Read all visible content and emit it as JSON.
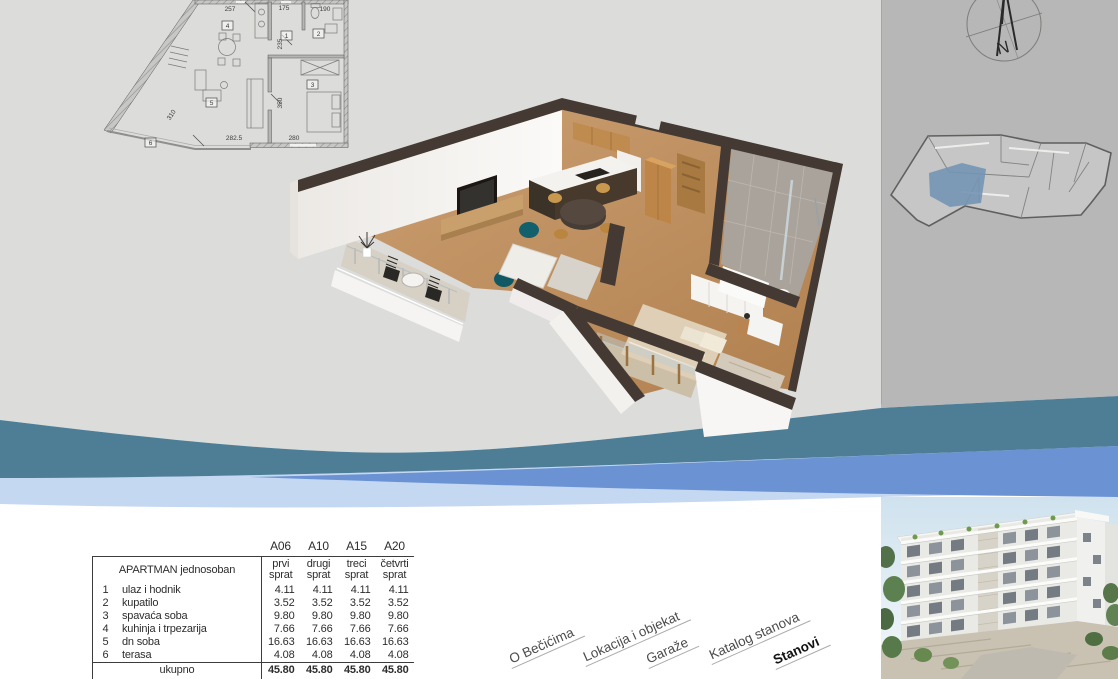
{
  "colors": {
    "bg_light_gray": "#dcdcda",
    "bg_column_gray": "#b7b7b7",
    "wave_teal": "#4e7e96",
    "wave_blue": "#6b92d3",
    "wave_light_blue": "#c5d8f1",
    "selected_unit_blue": "#7394b3",
    "wall_cap_brown": "#443a33"
  },
  "compass": {
    "north_label": "N"
  },
  "floorplan_2d": {
    "dims": {
      "top_left": "257",
      "top_mid": "175",
      "top_right": "190",
      "mid_v": "235",
      "lower_v": "350",
      "diagonal": "310",
      "bottom_left": "282.5",
      "bottom_right": "280"
    },
    "rooms": [
      "1",
      "2",
      "3",
      "4",
      "5",
      "6"
    ]
  },
  "area_table": {
    "units": [
      "A06",
      "A10",
      "A15",
      "A20"
    ],
    "row_header": "APARTMAN jednosoban",
    "floors": [
      {
        "l1": "prvi",
        "l2": "sprat"
      },
      {
        "l1": "drugi",
        "l2": "sprat"
      },
      {
        "l1": "treci",
        "l2": "sprat"
      },
      {
        "l1": "četvrti",
        "l2": "sprat"
      }
    ],
    "rows": [
      {
        "num": "1",
        "name": "ulaz i hodnik",
        "values": [
          "4.11",
          "4.11",
          "4.11",
          "4.11"
        ]
      },
      {
        "num": "2",
        "name": "kupatilo",
        "values": [
          "3.52",
          "3.52",
          "3.52",
          "3.52"
        ]
      },
      {
        "num": "3",
        "name": "spavaća soba",
        "values": [
          "9.80",
          "9.80",
          "9.80",
          "9.80"
        ]
      },
      {
        "num": "4",
        "name": "kuhinja i trpezarija",
        "values": [
          "7.66",
          "7.66",
          "7.66",
          "7.66"
        ]
      },
      {
        "num": "5",
        "name": "dn soba",
        "values": [
          "16.63",
          "16.63",
          "16.63",
          "16.63"
        ]
      },
      {
        "num": "6",
        "name": "terasa",
        "values": [
          "4.08",
          "4.08",
          "4.08",
          "4.08"
        ]
      }
    ],
    "total": {
      "label": "ukupno",
      "values": [
        "45.80",
        "45.80",
        "45.80",
        "45.80"
      ]
    }
  },
  "nav": {
    "links": [
      {
        "label": "O Bečićima"
      },
      {
        "label": "Lokacija i objekat"
      },
      {
        "label": "Garaže"
      },
      {
        "label": "Katalog stanova"
      },
      {
        "label": "Stanovi",
        "active": true
      }
    ]
  }
}
